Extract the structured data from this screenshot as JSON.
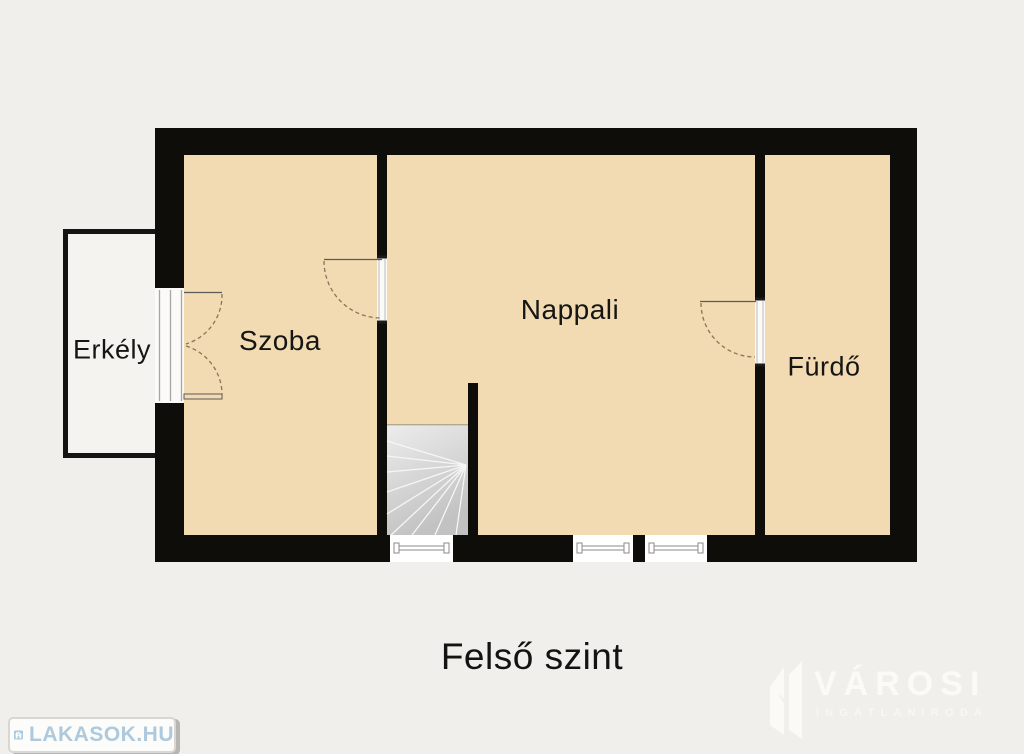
{
  "title": "Felső szint",
  "rooms": [
    {
      "id": "erkely",
      "label": "Erkély"
    },
    {
      "id": "szoba",
      "label": "Szoba"
    },
    {
      "id": "nappali",
      "label": "Nappali"
    },
    {
      "id": "furdo",
      "label": "Fürdő"
    }
  ],
  "plan": {
    "features": [
      "staircase",
      "balcony",
      "three-windows-bottom-wall",
      "single-doors",
      "double-balcony-door"
    ]
  },
  "watermarks": {
    "lakasok": {
      "text": "LAKASOK.HU",
      "icon": "house-icon"
    },
    "varosi": {
      "name": "VÁROSI",
      "subtitle": "INGATLANIRODA",
      "icon": "buildings-icon"
    }
  },
  "palette": {
    "background": "#f0efeb",
    "wall": "#0e0d0a",
    "room_fill": "#f2dbb2",
    "opening_white": "#fbfaf8",
    "balcony_fill": "#f4f3ef",
    "stairs_light": "#ededed",
    "stairs_dark": "#c2c2c2",
    "door_arc": "#86755d",
    "frame_gray": "#a5a5a1",
    "logo_blue": "#a9cadf",
    "watermark_white": "#fbfaf6"
  }
}
